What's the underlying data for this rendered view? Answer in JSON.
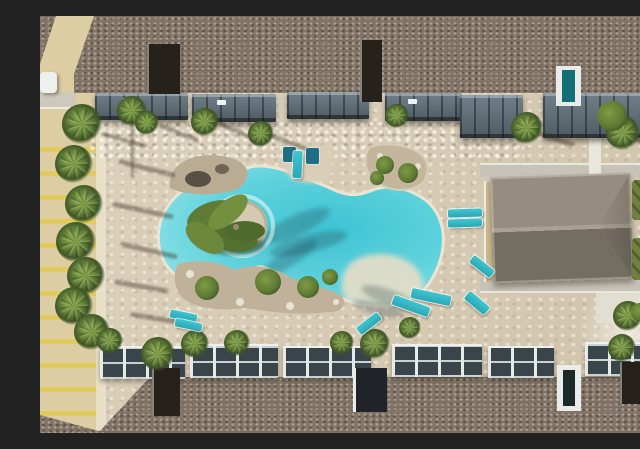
{
  "meta": {
    "title": "Aerial drone photo of apartment-complex lagoon pool",
    "image_width": 640,
    "image_height": 417,
    "visible_text": "none"
  },
  "scene": {
    "description": "Top-down aerial photograph of a resort-style freeform swimming pool courtyard surrounded by apartment buildings with brown shingle roofs, gray balconies, palm trees, a stone paver deck, teal lounge chairs, a gray-roofed clubhouse on the right, and a striped parking lot on the left.",
    "regions": {
      "pool": "Freeform turquoise lagoon pool with circular palm island, tanning shelf with in-water loungers, rock planters and a sandy beach entry",
      "parking": "Beige parking lot with yellow stripes and a row of palm trees",
      "top_building": "Apartment building with brown shingle roof and slate balconies",
      "bottom_building": "Apartment building with white-framed balconies facing the pool",
      "clubhouse": "Rectangular clubhouse with gray hip roof beside concrete walkways and grass strips"
    },
    "palette": {
      "deck": "#d8ccb4",
      "parking": "#dccda3",
      "stripe": "#e2cb5c",
      "roof": "#837567",
      "balcony_slate": "#4f5b62",
      "balcony_white": "#e7ebe8",
      "balcony_window": "#39444b",
      "club_roof_light": "#958d80",
      "club_roof_dark": "#746d62",
      "club_ridge": "#a9a193",
      "concrete": "#c8c3b8",
      "white_path": "#eae7de",
      "grass": "#71803f",
      "palm": "#5f7c36",
      "palm_light": "#81a048",
      "palm_dark": "#3f5526",
      "shrub": "#5e7a33",
      "rock": "#bcae94",
      "rock_dark": "#6e6557",
      "water_deep": "#3fc3d4",
      "water_main": "#5ed2dc",
      "water_light": "#9de6ea",
      "coping": "#ece5d3",
      "beach": "#e5dec7",
      "lounger": "#2ba7b6",
      "lounger_bright": "#3fc6cf",
      "lounger_dark": "#1f6f84",
      "shadow": "rgba(55,45,32,0.40)"
    },
    "top_balconies": [
      {
        "x": 55,
        "y": 77,
        "w": 93,
        "h": 27,
        "spec": 1
      },
      {
        "x": 152,
        "y": 78,
        "w": 84,
        "h": 28,
        "spec": 1
      },
      {
        "x": 247,
        "y": 76,
        "w": 82,
        "h": 27,
        "spec": 0
      },
      {
        "x": 345,
        "y": 77,
        "w": 77,
        "h": 28,
        "spec": 1
      },
      {
        "x": 420,
        "y": 79,
        "w": 63,
        "h": 43,
        "spec": 0
      },
      {
        "x": 503,
        "y": 77,
        "w": 110,
        "h": 45,
        "spec": 0
      }
    ],
    "bottom_balconies": [
      {
        "x": 60,
        "y": 330,
        "w": 85,
        "h": 33,
        "spec": 0
      },
      {
        "x": 150,
        "y": 328,
        "w": 88,
        "h": 34,
        "spec": 0
      },
      {
        "x": 243,
        "y": 330,
        "w": 88,
        "h": 32,
        "spec": 0
      },
      {
        "x": 352,
        "y": 328,
        "w": 90,
        "h": 33,
        "spec": 0
      },
      {
        "x": 448,
        "y": 330,
        "w": 66,
        "h": 32,
        "spec": 0
      },
      {
        "x": 545,
        "y": 326,
        "w": 95,
        "h": 34,
        "spec": 0
      }
    ],
    "roof_notches": [
      {
        "x": 107,
        "y": 28,
        "w": 33,
        "h": 50,
        "style": "dark"
      },
      {
        "x": 320,
        "y": 24,
        "w": 22,
        "h": 62,
        "style": "dark"
      },
      {
        "x": 516,
        "y": 50,
        "w": 25,
        "h": 40,
        "style": "white door"
      },
      {
        "x": 112,
        "y": 352,
        "w": 28,
        "h": 48,
        "style": "dark"
      },
      {
        "x": 313,
        "y": 352,
        "w": 34,
        "h": 44,
        "style": "whitedark"
      },
      {
        "x": 517,
        "y": 349,
        "w": 24,
        "h": 46,
        "style": "white"
      },
      {
        "x": 580,
        "y": 346,
        "w": 27,
        "h": 42,
        "style": "dark"
      }
    ],
    "palms": [
      {
        "x": 42,
        "y": 108,
        "r": 20
      },
      {
        "x": 34,
        "y": 148,
        "r": 19
      },
      {
        "x": 44,
        "y": 188,
        "r": 19
      },
      {
        "x": 36,
        "y": 226,
        "r": 20
      },
      {
        "x": 46,
        "y": 260,
        "r": 19
      },
      {
        "x": 34,
        "y": 290,
        "r": 19
      },
      {
        "x": 52,
        "y": 316,
        "r": 18
      },
      {
        "x": 92,
        "y": 95,
        "r": 15
      },
      {
        "x": 107,
        "y": 107,
        "r": 12
      },
      {
        "x": 165,
        "y": 106,
        "r": 14
      },
      {
        "x": 221,
        "y": 118,
        "r": 13
      },
      {
        "x": 357,
        "y": 100,
        "r": 12
      },
      {
        "x": 487,
        "y": 112,
        "r": 16
      },
      {
        "x": 583,
        "y": 117,
        "r": 17
      },
      {
        "x": 70,
        "y": 325,
        "r": 13
      },
      {
        "x": 118,
        "y": 338,
        "r": 17
      },
      {
        "x": 155,
        "y": 328,
        "r": 14
      },
      {
        "x": 197,
        "y": 327,
        "r": 13
      },
      {
        "x": 302,
        "y": 327,
        "r": 12
      },
      {
        "x": 335,
        "y": 328,
        "r": 15
      },
      {
        "x": 588,
        "y": 300,
        "r": 15
      },
      {
        "x": 582,
        "y": 332,
        "r": 14
      },
      {
        "x": 370,
        "y": 312,
        "r": 11
      }
    ],
    "palm_shadows": [
      {
        "x": 78,
        "y": 150,
        "w": 58,
        "h": 5,
        "rot": 14
      },
      {
        "x": 72,
        "y": 192,
        "w": 62,
        "h": 5,
        "rot": 12
      },
      {
        "x": 80,
        "y": 232,
        "w": 58,
        "h": 5,
        "rot": 13
      },
      {
        "x": 74,
        "y": 268,
        "w": 55,
        "h": 5,
        "rot": 10
      },
      {
        "x": 90,
        "y": 300,
        "w": 52,
        "h": 5,
        "rot": 9
      },
      {
        "x": 60,
        "y": 122,
        "w": 48,
        "h": 4,
        "rot": 16
      },
      {
        "x": 118,
        "y": 115,
        "w": 42,
        "h": 4,
        "rot": 22
      },
      {
        "x": 172,
        "y": 112,
        "w": 44,
        "h": 4,
        "rot": 24
      },
      {
        "x": 228,
        "y": 124,
        "w": 40,
        "h": 4,
        "rot": 20
      },
      {
        "x": 492,
        "y": 120,
        "w": 44,
        "h": 5,
        "rot": 18
      },
      {
        "x": 592,
        "y": 126,
        "w": 46,
        "h": 5,
        "rot": 16
      },
      {
        "x": 91,
        "y": 98,
        "w": 3,
        "h": 64,
        "rot": 0
      },
      {
        "x": 600,
        "y": 180,
        "w": 40,
        "h": 5,
        "rot": 20
      },
      {
        "x": 604,
        "y": 235,
        "w": 42,
        "h": 5,
        "rot": 22
      }
    ],
    "shrubs": [
      {
        "x": 167,
        "y": 272,
        "r": 12
      },
      {
        "x": 228,
        "y": 266,
        "r": 13
      },
      {
        "x": 268,
        "y": 271,
        "r": 11
      },
      {
        "x": 290,
        "y": 261,
        "r": 8
      },
      {
        "x": 345,
        "y": 149,
        "r": 9
      },
      {
        "x": 368,
        "y": 157,
        "r": 10
      },
      {
        "x": 337,
        "y": 162,
        "r": 7
      },
      {
        "x": 572,
        "y": 100,
        "r": 15
      },
      {
        "x": 600,
        "y": 296,
        "r": 9
      }
    ],
    "grass_patches": [
      {
        "x": 592,
        "y": 164,
        "w": 48,
        "h": 40
      },
      {
        "x": 592,
        "y": 222,
        "w": 48,
        "h": 42
      }
    ],
    "loungers": [
      {
        "x": 408,
        "y": 193,
        "w": 34,
        "h": 8,
        "rot": -2,
        "v": "b"
      },
      {
        "x": 408,
        "y": 203,
        "w": 34,
        "h": 8,
        "rot": -2,
        "v": "b"
      },
      {
        "x": 429,
        "y": 246,
        "w": 26,
        "h": 9,
        "rot": 38,
        "v": "b"
      },
      {
        "x": 352,
        "y": 285,
        "w": 38,
        "h": 10,
        "rot": 20,
        "v": "b"
      },
      {
        "x": 371,
        "y": 276,
        "w": 40,
        "h": 10,
        "rot": 12,
        "v": "b"
      },
      {
        "x": 424,
        "y": 282,
        "w": 26,
        "h": 10,
        "rot": 40,
        "v": "b"
      },
      {
        "x": 316,
        "y": 303,
        "w": 26,
        "h": 9,
        "rot": -38,
        "v": "b"
      },
      {
        "x": 130,
        "y": 296,
        "w": 27,
        "h": 8,
        "rot": 12,
        "v": "b"
      },
      {
        "x": 135,
        "y": 305,
        "w": 27,
        "h": 8,
        "rot": 12,
        "v": "b"
      },
      {
        "x": 613,
        "y": 129,
        "w": 16,
        "h": 7,
        "rot": -12,
        "v": "b"
      },
      {
        "x": 243,
        "y": 131,
        "w": 13,
        "h": 15,
        "rot": 0,
        "v": "d"
      },
      {
        "x": 253,
        "y": 135,
        "w": 9,
        "h": 27,
        "rot": 3,
        "v": "b"
      },
      {
        "x": 266,
        "y": 132,
        "w": 13,
        "h": 16,
        "rot": 0,
        "v": "d"
      }
    ]
  }
}
